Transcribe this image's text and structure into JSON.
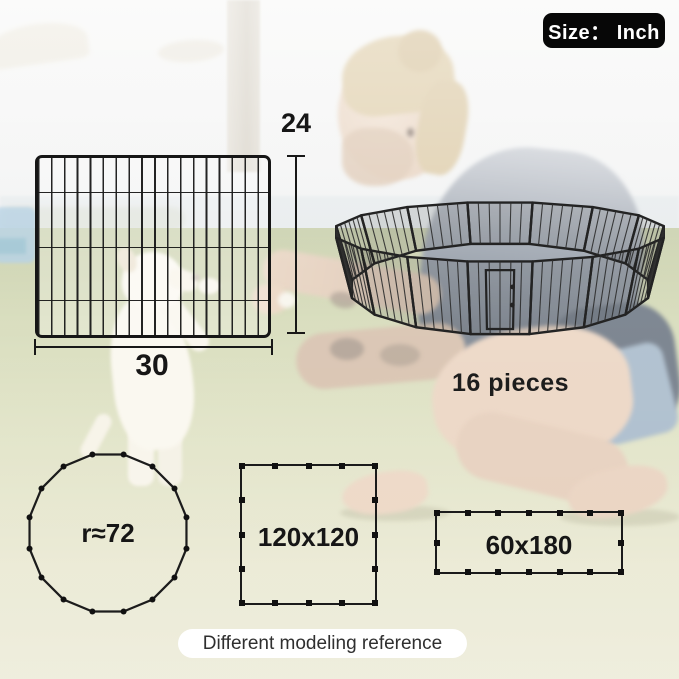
{
  "size_badge": {
    "label": "Size： Inch"
  },
  "panel_diagram": {
    "width_label": "30",
    "height_label": "24"
  },
  "playpen": {
    "pieces_label": "16 pieces",
    "panel_count": 16
  },
  "modeling_reference": {
    "caption": "Different modeling reference",
    "shapes": [
      {
        "type": "polygon-circle",
        "sides": 16,
        "label": "r≈72"
      },
      {
        "type": "square",
        "segments_per_side": 4,
        "label": "120x120"
      },
      {
        "type": "rectangle",
        "segments_top_bottom": 6,
        "segments_sides": 2,
        "label": "60x180"
      }
    ]
  },
  "colors": {
    "annotation": "#161616",
    "badge_bg": "#070707",
    "badge_text": "#ffffff",
    "caption_bg": "#ffffff",
    "caption_text": "#2f2f2f"
  }
}
